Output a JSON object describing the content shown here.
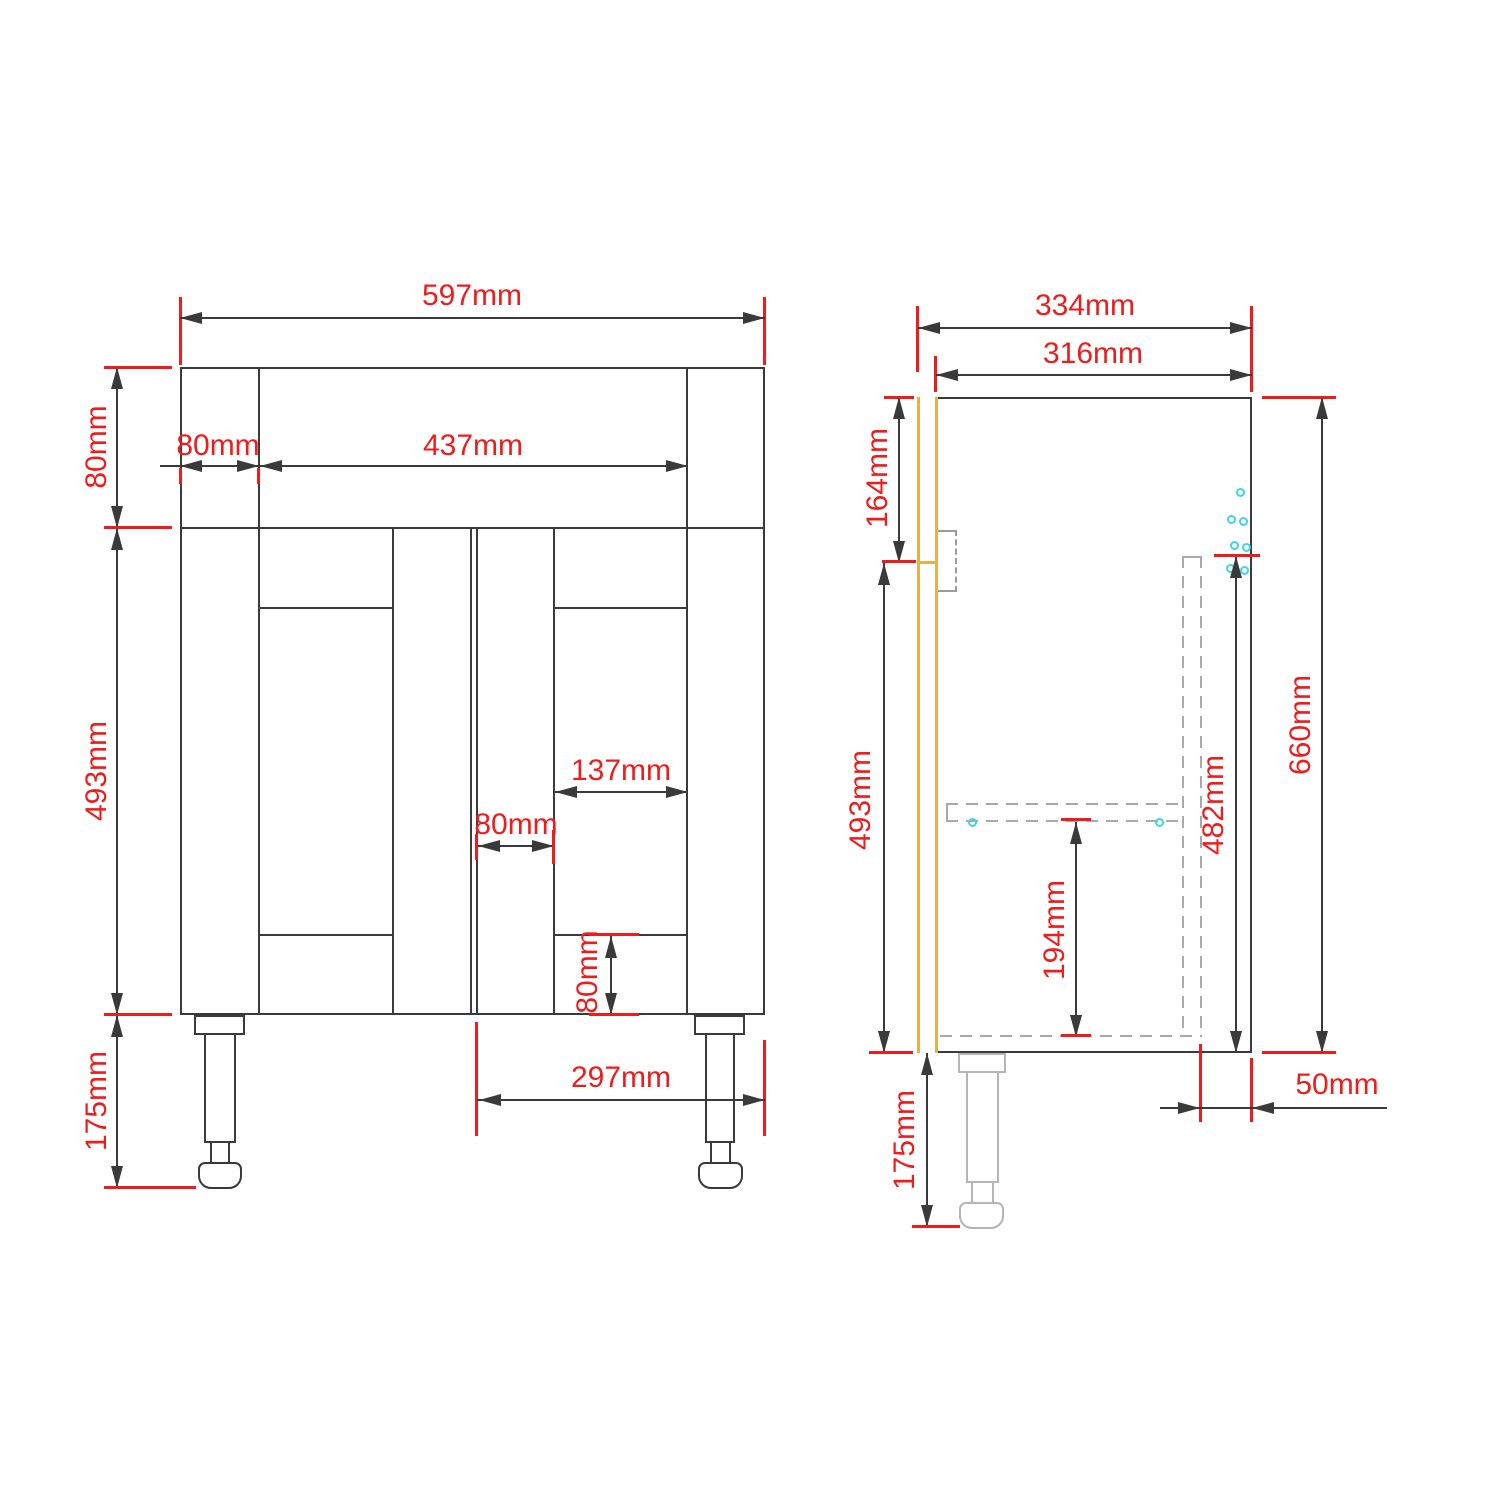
{
  "title": "Vanity unit technical drawing",
  "colors": {
    "line": "#3a3a3a",
    "dimension_red": "#ee1c1c",
    "door_slab_yellow": "#e8b049",
    "hardware_cyan": "#3fd4e6",
    "hidden_gray": "#a9a9a9",
    "leg_side_gray": "#b5b5b5",
    "background": "#ffffff"
  },
  "front_view": {
    "name": "front-elevation",
    "dims": {
      "overall_width": "597mm",
      "side_stile_width": "80mm",
      "drawer_front_width": "437mm",
      "top_rail_height": "80mm",
      "door_height": "493mm",
      "leg_height": "175mm",
      "door_panel_width": "137mm",
      "door_stile_width": "80mm",
      "door_bottom_rail_height": "80mm",
      "door_width": "297mm"
    }
  },
  "side_view": {
    "name": "side-elevation",
    "dims": {
      "overall_depth": "334mm",
      "carcass_depth": "316mm",
      "top_section_height": "164mm",
      "door_height": "493mm",
      "overall_height": "660mm",
      "back_panel_height": "482mm",
      "shelf_height": "194mm",
      "leg_height": "175mm",
      "back_inset": "50mm"
    }
  }
}
